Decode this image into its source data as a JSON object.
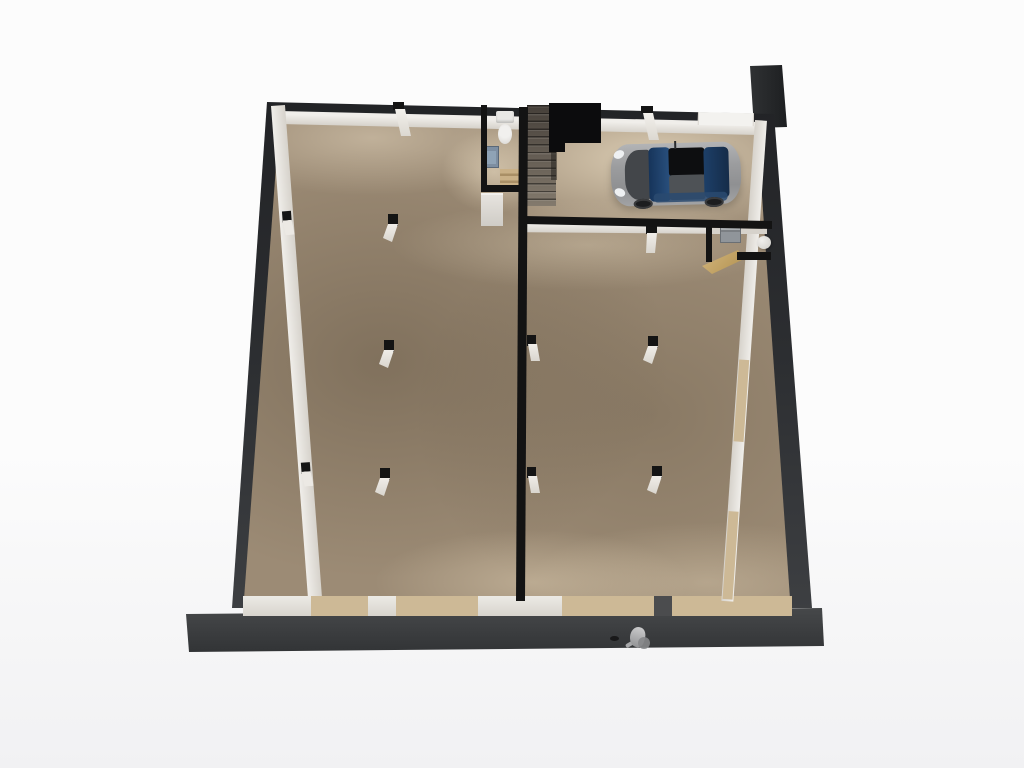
{
  "scene": {
    "type": "3d-floorplan-render",
    "view": "top-down perspective",
    "description": "Architectural 3D render of a ground floor: two large empty halls, a staircase with WC and under-stair cabinet, a garage bay with a parked silver hatchback, a small utility closet, structural columns, window sills, a dark foundation ledge and a chimney stub.",
    "rooms": [
      {
        "id": "left-hall"
      },
      {
        "id": "right-hall"
      },
      {
        "id": "garage"
      },
      {
        "id": "stairwell"
      },
      {
        "id": "wc"
      },
      {
        "id": "utility-closet"
      }
    ],
    "objects": [
      {
        "id": "car",
        "kind": "silver hatchback, parked, nose left"
      },
      {
        "id": "staircase",
        "kind": "straight run with wooden winders and black stair void"
      },
      {
        "id": "toilet",
        "kind": "wc fixture"
      },
      {
        "id": "wash-panel",
        "kind": "blue-gray fixture"
      },
      {
        "id": "utility-panel",
        "kind": "gray wall unit"
      },
      {
        "id": "water-heater",
        "kind": "white cylinder"
      },
      {
        "id": "wood-counter",
        "kind": "slanted wooden wedge at closet door"
      },
      {
        "id": "columns",
        "count": 12
      },
      {
        "id": "foundation-ledge"
      },
      {
        "id": "chimney-stub"
      },
      {
        "id": "small-figure",
        "kind": "tiny gray object on ledge"
      }
    ]
  },
  "colors": {
    "bg": "#fcfcfc",
    "bg_low": "#f1f1f3",
    "ledge_a": "#47494b",
    "ledge_b": "#313335",
    "wall_a": "#222326",
    "wall_b": "#3d3f42",
    "chimney": "#1d1f21",
    "iwall": "#131313",
    "face_a": "#f0eeea",
    "face_b": "#d6d2cb",
    "floor_base": "#9c8b75",
    "sill": "#cdb996",
    "void": "#0c0c0d",
    "stair_a": "#453f39",
    "stair_b": "#837a6d",
    "stair_wood": "#c9b087",
    "wood_a": "#d3b67d",
    "wood_b": "#b2914f",
    "box_white": "#cfccc6",
    "fixture_white": "#e9e8e5",
    "fixture_blue": "#7d8ea1",
    "panel_gray": "#90959a",
    "car_dark": "#43464a",
    "car_glass_a": "#16345a",
    "car_glass_b": "#2a517f",
    "car_roof": "#4e5256",
    "car_black": "#0d0e10",
    "wheel": "#1c1d1f",
    "pillar_cap": "#141414",
    "pillar_body": "#ece9e4",
    "figure_a": "#cacacb",
    "figure_b": "#939496"
  }
}
